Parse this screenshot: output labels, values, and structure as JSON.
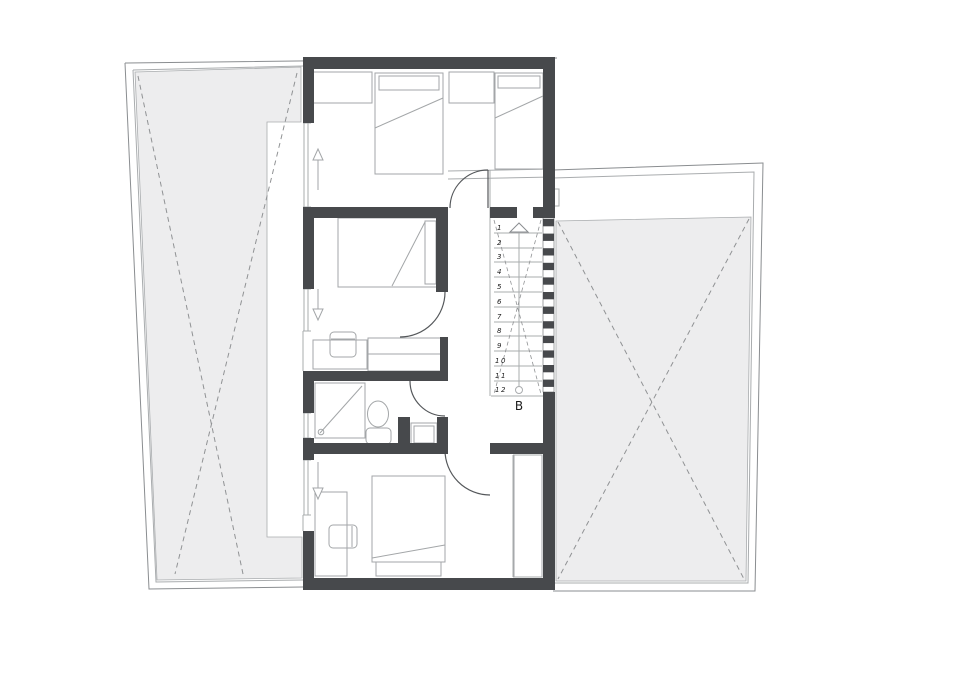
{
  "title": "first-floor-plan",
  "stairs": {
    "steps": [
      "1",
      "2",
      "3",
      "4",
      "5",
      "6",
      "7",
      "8",
      "9",
      "10",
      "11",
      "12"
    ],
    "entry_label": "B"
  },
  "colors": {
    "wall": "#47494c",
    "roof": "#ededee",
    "line": "#8a8d90",
    "line2": "#a9acae",
    "dash": "#909294",
    "furn": "#a3a6a8",
    "ink": "#1c1c1c"
  }
}
